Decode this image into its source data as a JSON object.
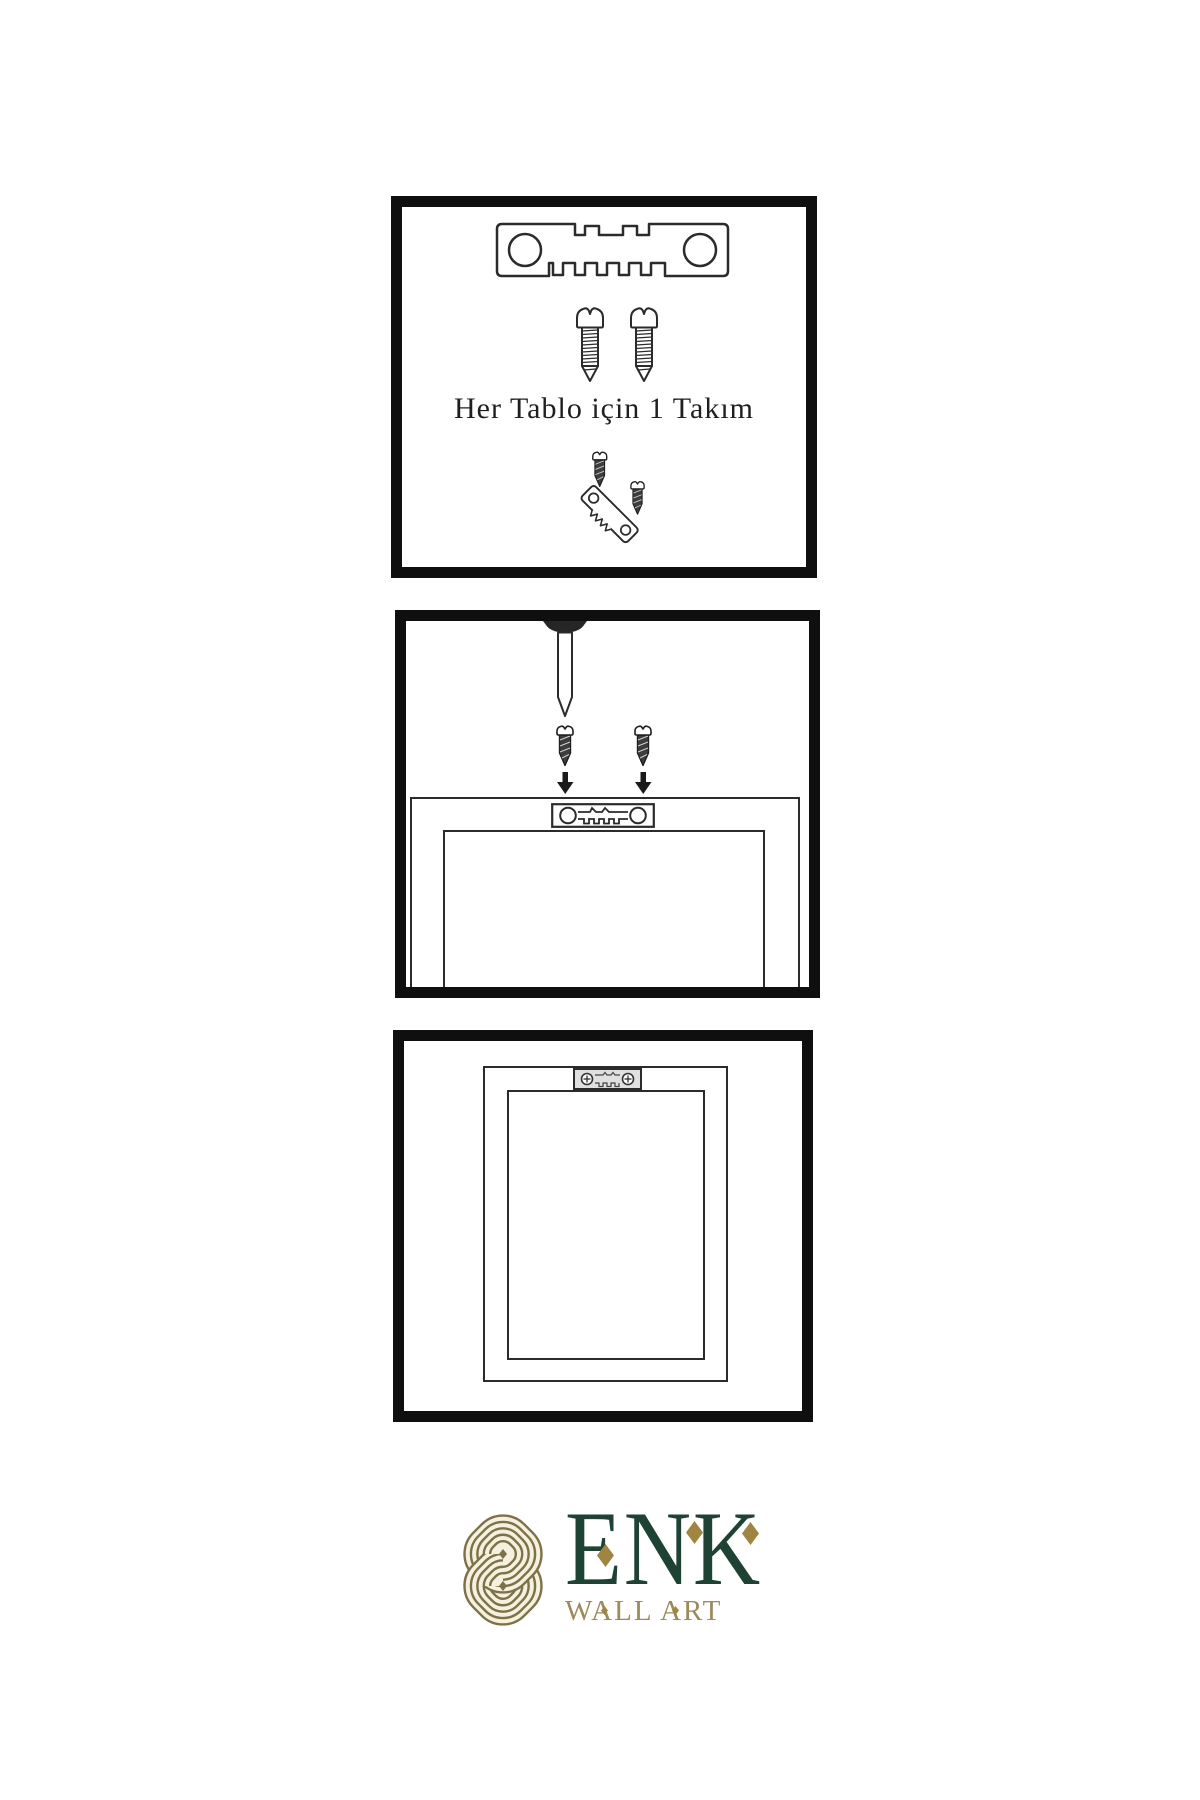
{
  "page": {
    "background": "#ffffff"
  },
  "instructions": {
    "panel1": {
      "name": "hardware-kit",
      "caption": "Her Tablo için 1 Takım",
      "items": [
        "sawtooth-hanger",
        "screw",
        "screw",
        "screws-into-hanger-assembly"
      ]
    },
    "panel2": {
      "name": "installation-step",
      "items": [
        "wall-nail",
        "screw",
        "screw",
        "down-arrow",
        "down-arrow",
        "frame-back",
        "sawtooth-hanger-mounted"
      ]
    },
    "panel3": {
      "name": "finished-back",
      "items": [
        "frame-back",
        "sawtooth-hanger-installed"
      ]
    }
  },
  "logo": {
    "title": "ENK",
    "subtitle": "WALL ART",
    "emblem": "interlocking-knot-emblem",
    "colors": {
      "title_green": "#1e4334",
      "subtitle_gold": "#9c8a5c",
      "emblem_gold": "#7d7148",
      "emblem_cream": "#f6f0df",
      "diamond_gold": "#a08441"
    }
  },
  "colors": {
    "panel_border": "#0f0f0f",
    "line_art": "#2b2b2b",
    "dark_metal": "#3d3d3d",
    "background": "#ffffff"
  }
}
